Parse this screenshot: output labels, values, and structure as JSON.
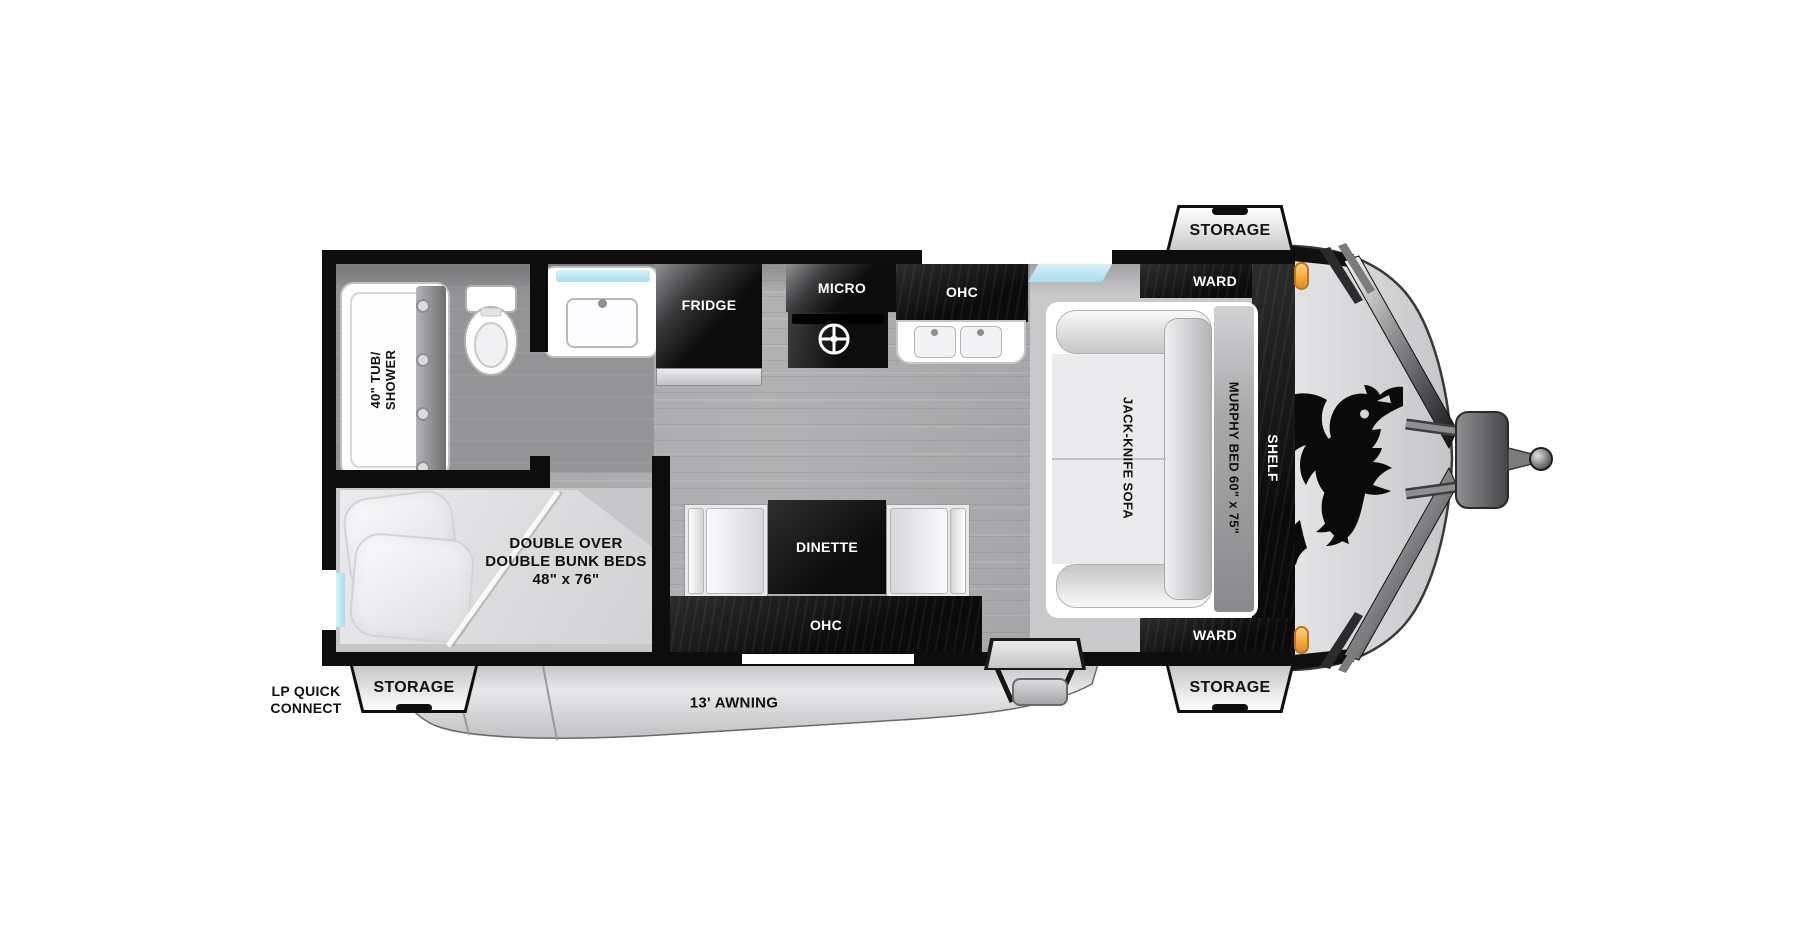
{
  "colors": {
    "wall": "#0d0d0d",
    "cabinet_dark": "#151515",
    "floor_wood": "#a7a7a9",
    "floor_bath": "#949496",
    "floor_entry": "#c9c9cb",
    "nose_gray": "#d5d5d7",
    "awning_gray": "#d8d8da",
    "window_blue": "#a9dcee",
    "marker_orange": "#f3a73a",
    "fixture_white": "#ffffff"
  },
  "labels": {
    "storage_top": "STORAGE",
    "ward_top": "WARD",
    "shelf": "SHELF",
    "murphy_bed": "MURPHY BED 60\" x 75\"",
    "jack_knife_sofa": "JACK-KNIFE SOFA",
    "fridge": "FRIDGE",
    "micro": "MICRO",
    "ohc_kitchen": "OHC",
    "tub_line1": "40\" TUB/",
    "tub_line2": "SHOWER",
    "dinette": "DINETTE",
    "ohc_dinette": "OHC",
    "ward_bottom": "WARD",
    "bunk_line1": "DOUBLE OVER",
    "bunk_line2": "DOUBLE BUNK BEDS",
    "bunk_line3": "48\" x 76\"",
    "lp_line1": "LP QUICK",
    "lp_line2": "CONNECT",
    "storage_bottom_left": "STORAGE",
    "awning": "13' AWNING",
    "storage_bottom_right": "STORAGE"
  }
}
